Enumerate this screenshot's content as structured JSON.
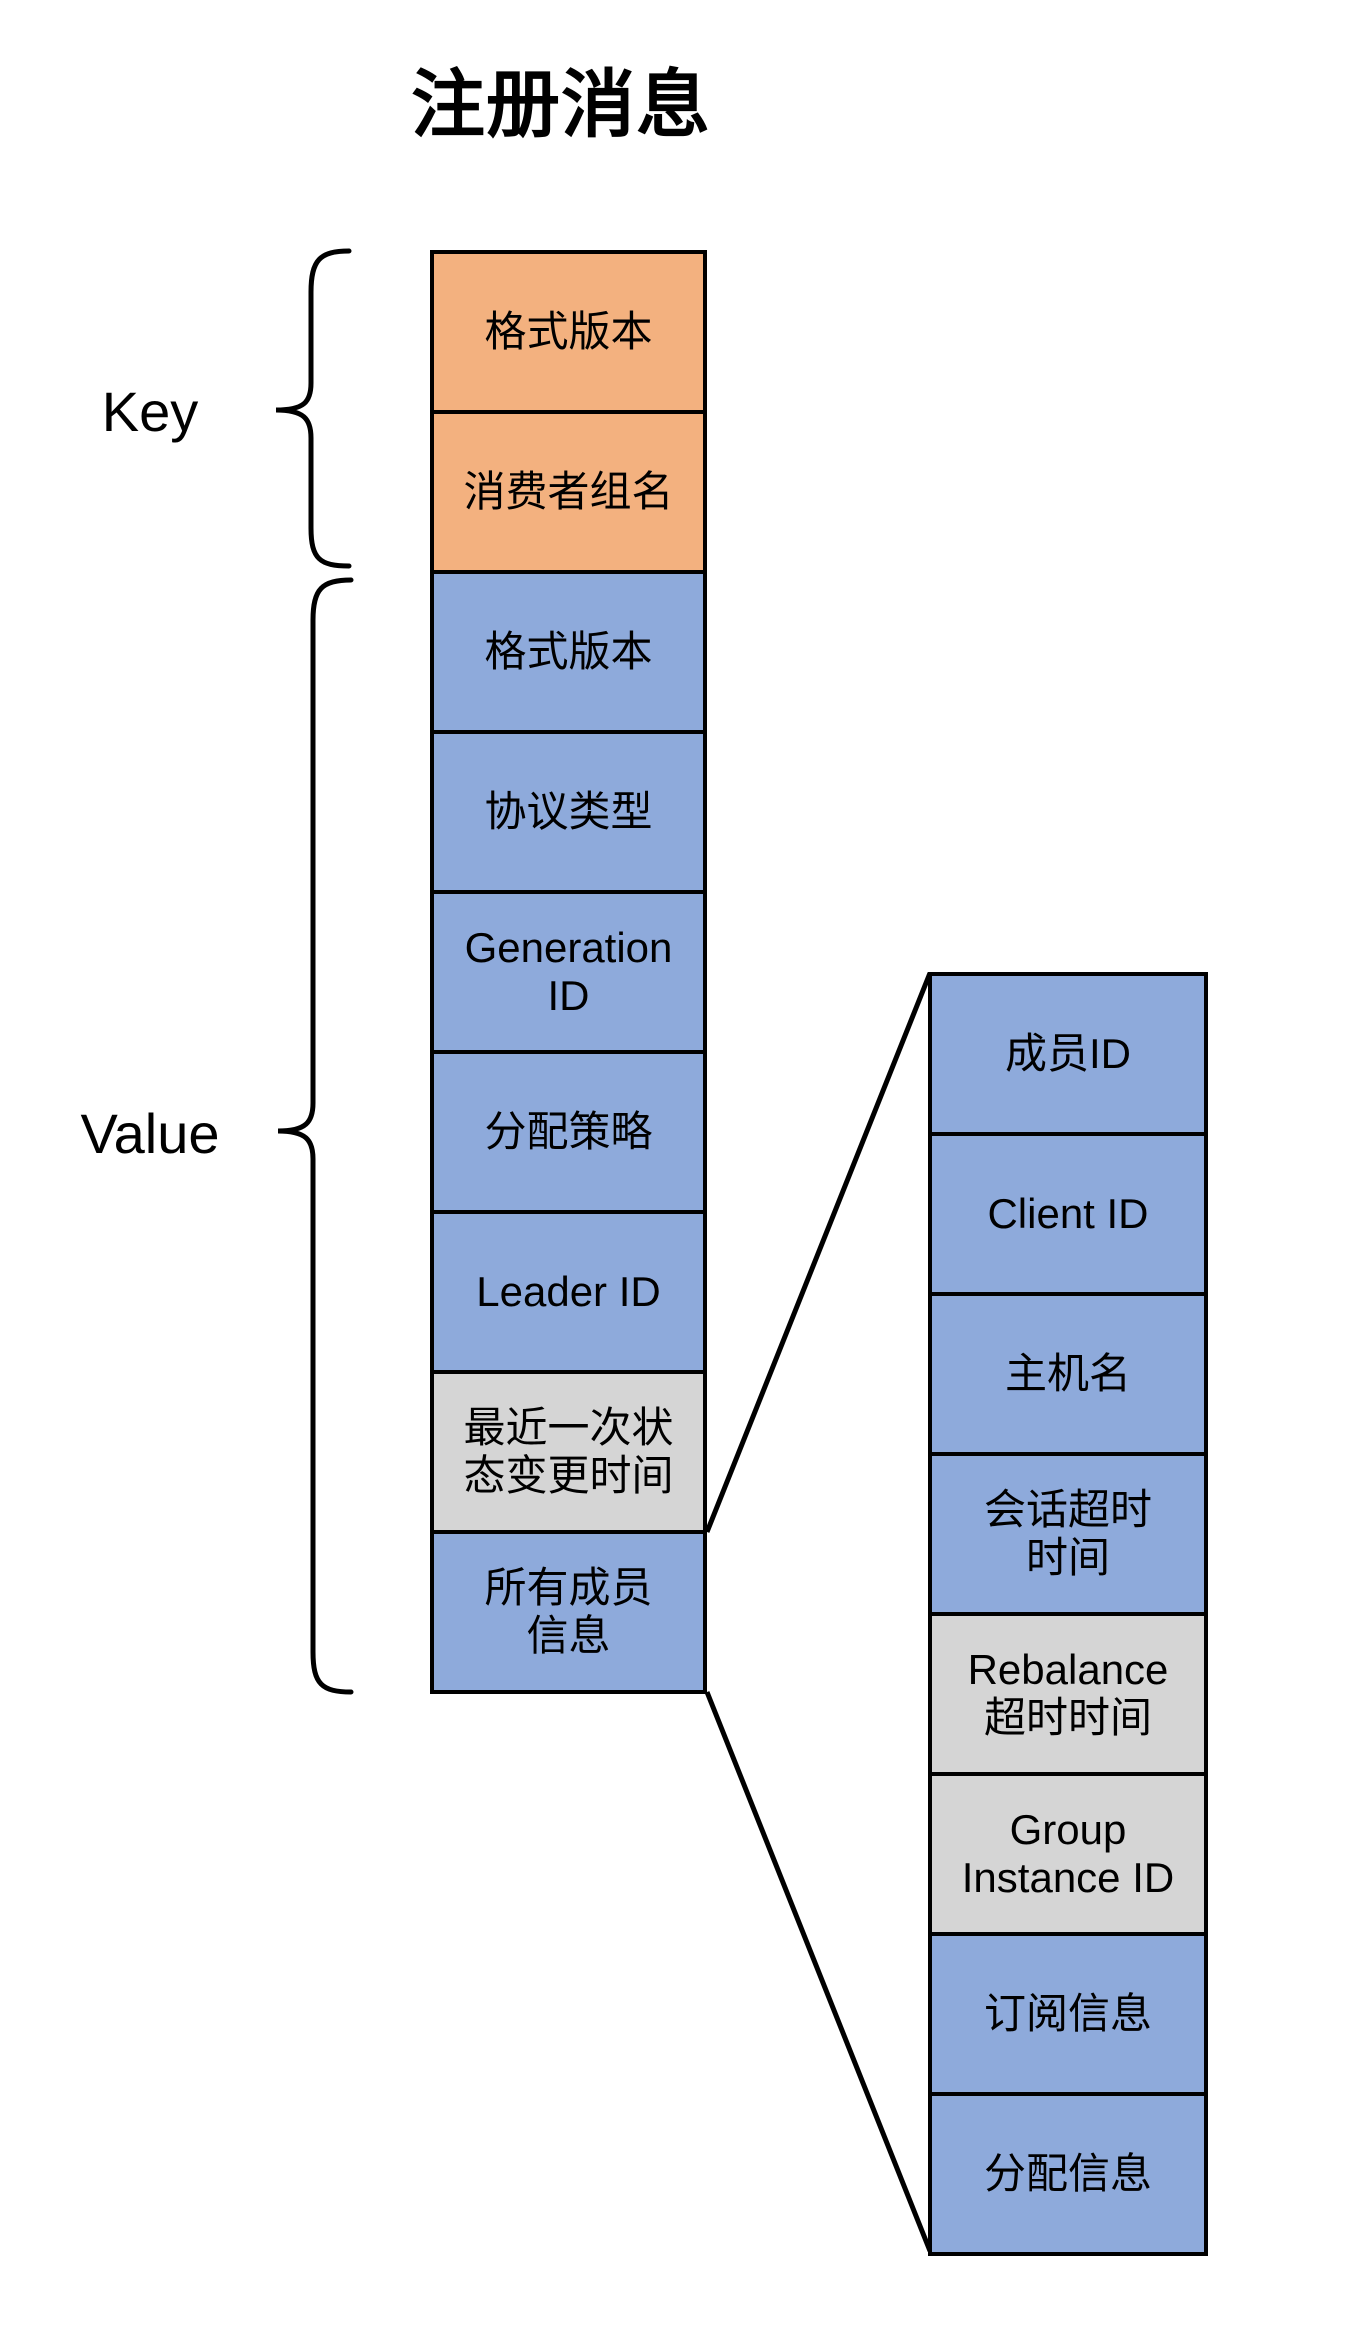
{
  "title": "注册消息",
  "sections": {
    "key_label": "Key",
    "value_label": "Value"
  },
  "colors": {
    "key_fill": "#F3B17F",
    "value_fill": "#8EAADB",
    "optional_fill": "#D5D5D5",
    "outline": "#000000",
    "background": "#FFFFFF"
  },
  "message_column": {
    "boxes": [
      {
        "label": "格式版本",
        "fill": "#F3B17F",
        "section": "key"
      },
      {
        "label": "消费者组名",
        "fill": "#F3B17F",
        "section": "key"
      },
      {
        "label": "格式版本",
        "fill": "#8EAADB",
        "section": "value"
      },
      {
        "label": "协议类型",
        "fill": "#8EAADB",
        "section": "value"
      },
      {
        "label": "Generation\nID",
        "fill": "#8EAADB",
        "section": "value"
      },
      {
        "label": "分配策略",
        "fill": "#8EAADB",
        "section": "value"
      },
      {
        "label": "Leader ID",
        "fill": "#8EAADB",
        "section": "value"
      },
      {
        "label": "最近一次状\n态变更时间",
        "fill": "#D5D5D5",
        "section": "value"
      },
      {
        "label": "所有成员\n信息",
        "fill": "#8EAADB",
        "section": "value"
      }
    ]
  },
  "member_column": {
    "boxes": [
      {
        "label": "成员ID",
        "fill": "#8EAADB"
      },
      {
        "label": "Client ID",
        "fill": "#8EAADB"
      },
      {
        "label": "主机名",
        "fill": "#8EAADB"
      },
      {
        "label": "会话超时\n时间",
        "fill": "#8EAADB"
      },
      {
        "label": "Rebalance\n超时时间",
        "fill": "#D5D5D5"
      },
      {
        "label": "Group\nInstance ID",
        "fill": "#D5D5D5"
      },
      {
        "label": "订阅信息",
        "fill": "#8EAADB"
      },
      {
        "label": "分配信息",
        "fill": "#8EAADB"
      }
    ]
  }
}
